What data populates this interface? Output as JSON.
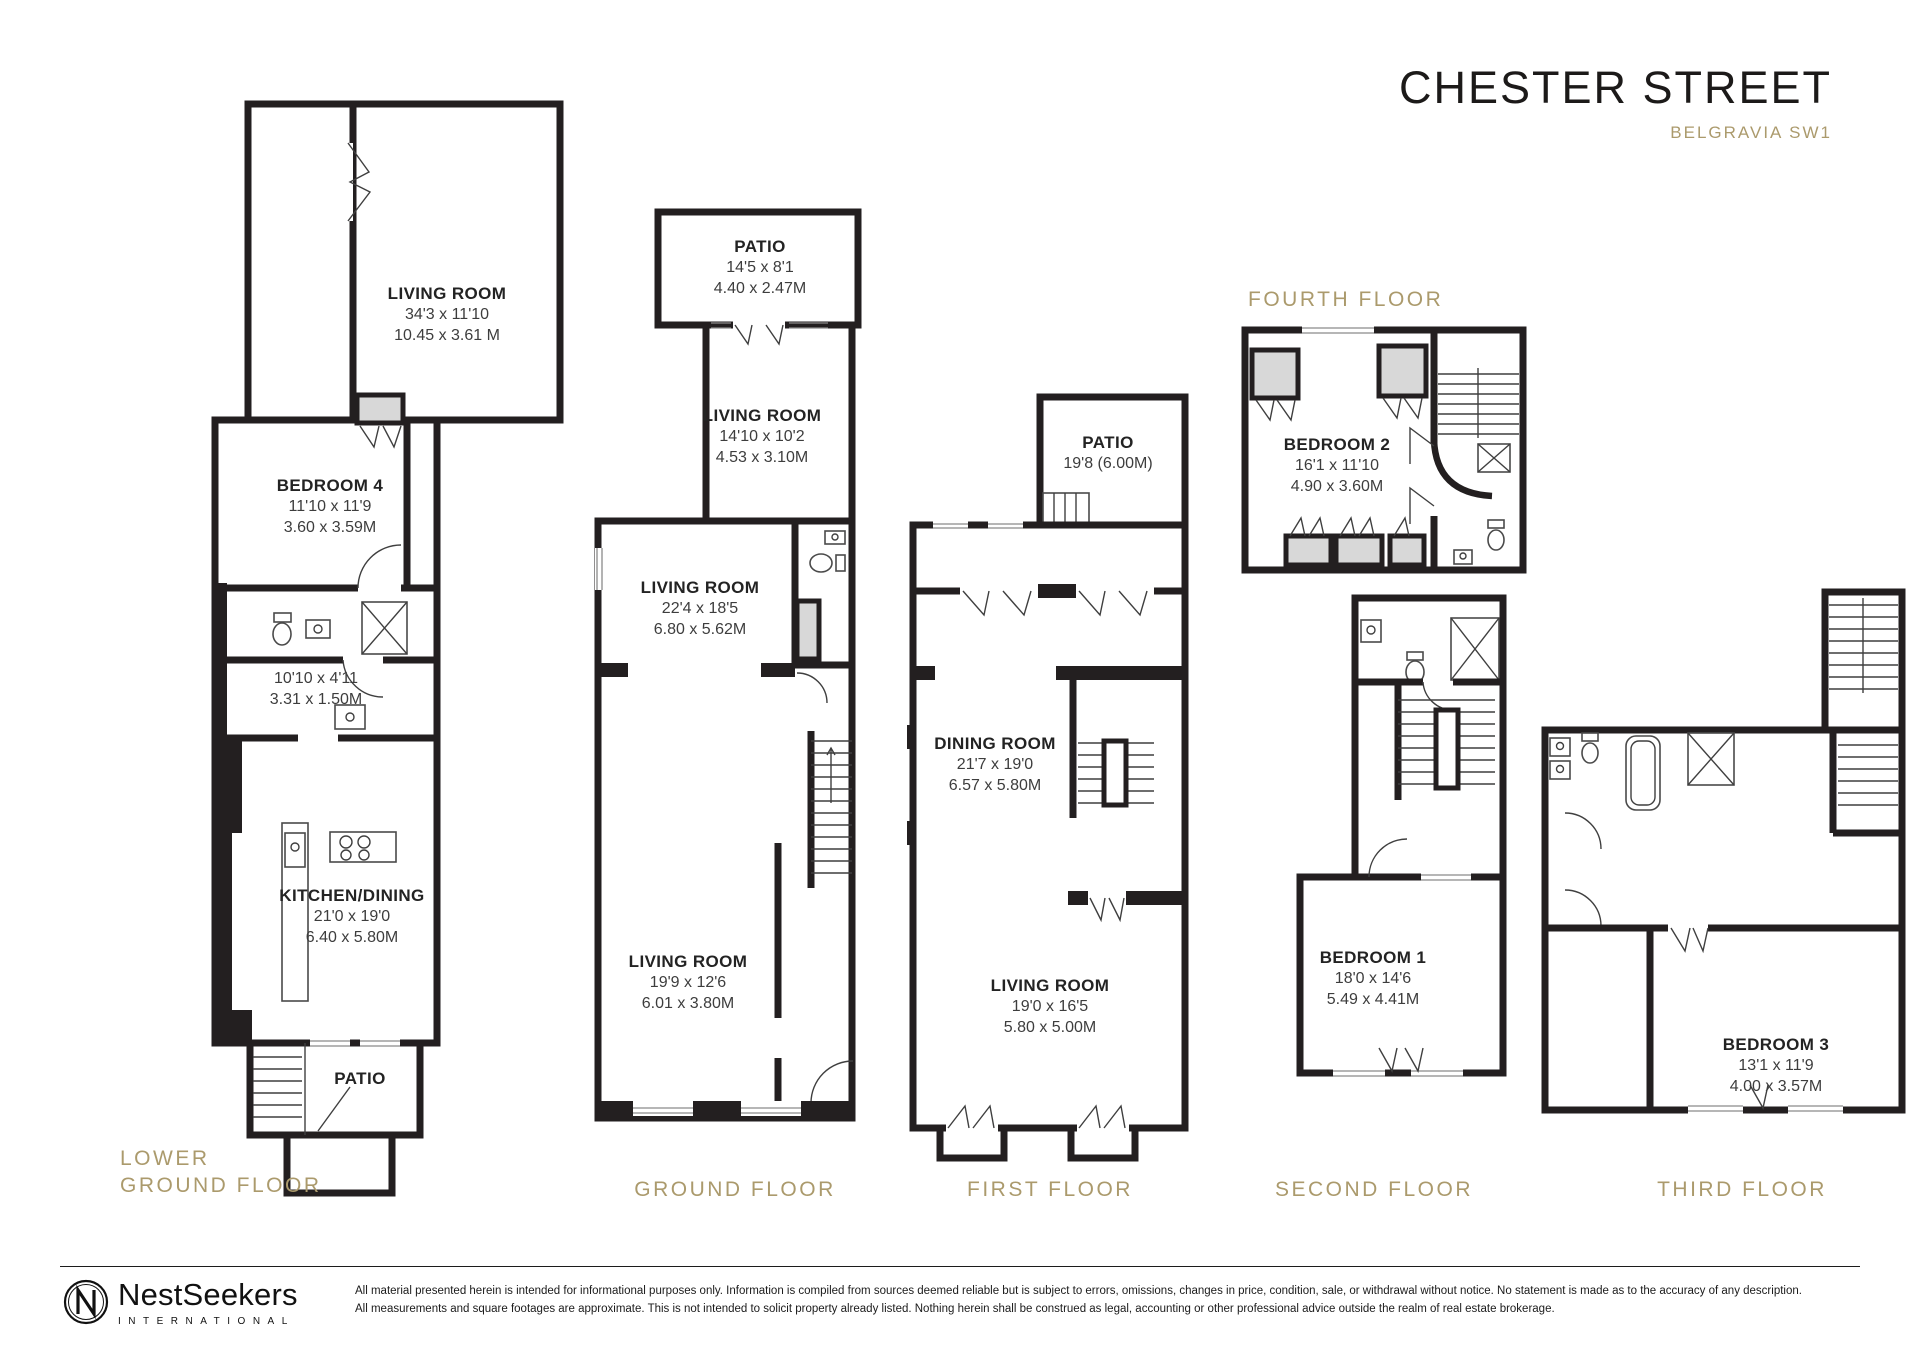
{
  "header": {
    "title": "CHESTER STREET",
    "subtitle": "BELGRAVIA SW1"
  },
  "floors": {
    "lower_ground": {
      "label_line1": "LOWER",
      "label_line2": "GROUND FLOOR",
      "rooms": [
        {
          "name": "LIVING ROOM",
          "imperial": "34'3 x 11'10",
          "metric": "10.45 x 3.61 M"
        },
        {
          "name": "BEDROOM 4",
          "imperial": "11'10 x 11'9",
          "metric": "3.60 x 3.59M"
        },
        {
          "imperial": "10'10 x 4'11",
          "metric": "3.31 x 1.50M"
        },
        {
          "name": "KITCHEN/DINING",
          "imperial": "21'0 x 19'0",
          "metric": "6.40 x 5.80M"
        },
        {
          "name": "PATIO"
        }
      ]
    },
    "ground": {
      "label": "GROUND FLOOR",
      "rooms": [
        {
          "name": "PATIO",
          "imperial": "14'5 x 8'1",
          "metric": "4.40 x 2.47M"
        },
        {
          "name": "LIVING ROOM",
          "imperial": "14'10 x 10'2",
          "metric": "4.53 x 3.10M"
        },
        {
          "name": "LIVING ROOM",
          "imperial": "22'4 x 18'5",
          "metric": "6.80 x 5.62M"
        },
        {
          "name": "LIVING ROOM",
          "imperial": "19'9 x 12'6",
          "metric": "6.01 x 3.80M"
        }
      ]
    },
    "first": {
      "label": "FIRST FLOOR",
      "rooms": [
        {
          "name": "PATIO",
          "imperial": "19'8 (6.00M)"
        },
        {
          "name": "DINING ROOM",
          "imperial": "21'7 x 19'0",
          "metric": "6.57 x 5.80M"
        },
        {
          "name": "LIVING ROOM",
          "imperial": "19'0 x 16'5",
          "metric": "5.80 x 5.00M"
        }
      ]
    },
    "second": {
      "label": "SECOND FLOOR",
      "rooms": [
        {
          "name": "BEDROOM 1",
          "imperial": "18'0 x 14'6",
          "metric": "5.49 x 4.41M"
        }
      ]
    },
    "third": {
      "label": "THIRD FLOOR",
      "rooms": [
        {
          "name": "BEDROOM 3",
          "imperial": "13'1 x 11'9",
          "metric": "4.00 x 3.57M"
        }
      ]
    },
    "fourth": {
      "label": "FOURTH FLOOR",
      "rooms": [
        {
          "name": "BEDROOM 2",
          "imperial": "16'1 x 11'10",
          "metric": "4.90 x 3.60M"
        }
      ]
    }
  },
  "footer": {
    "brand": "NestSeekers",
    "brand_sub": "INTERNATIONAL",
    "disclaimer_line1": "All material presented herein is intended for informational purposes only. Information is compiled from sources deemed reliable but is subject to errors, omissions, changes in price, condition, sale, or withdrawal without notice. No statement is made as to the accuracy of any description.",
    "disclaimer_line2": "All measurements and square footages are approximate. This is not intended to solicit property already listed. Nothing herein shall be construed as legal, accounting or other professional advice outside the realm of real estate brokerage."
  },
  "colors": {
    "gold": "#ab9a6c",
    "wall": "#231f20",
    "gray": "#d8d8d8"
  },
  "icons": {
    "nestseekers-logo": "circled N monogram",
    "toilet": "ellipse with cistern",
    "sink": "rect basin with tap",
    "shower": "square with X",
    "bathtub": "rounded rect",
    "stove": "rect with 4 burners",
    "stairs": "parallel tread lines"
  }
}
